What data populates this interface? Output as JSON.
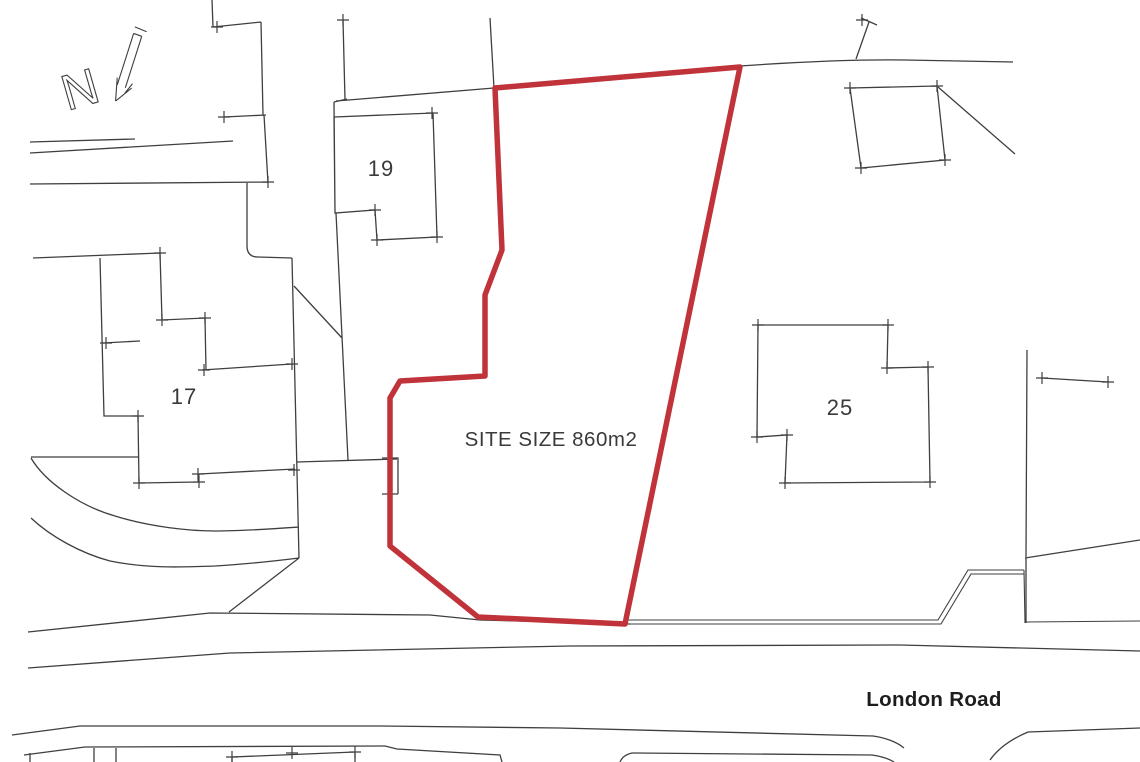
{
  "document": {
    "type": "site-location-plan",
    "labels": {
      "north_indicator": "N",
      "house_19": "19",
      "house_17": "17",
      "house_25": "25",
      "site_size": "SITE SIZE 860m2",
      "road_name": "London Road"
    },
    "colors": {
      "site_boundary": "#c0333a",
      "linework": "#3f3f3f",
      "text": "#3a3a3a",
      "background": "#ffffff"
    }
  }
}
